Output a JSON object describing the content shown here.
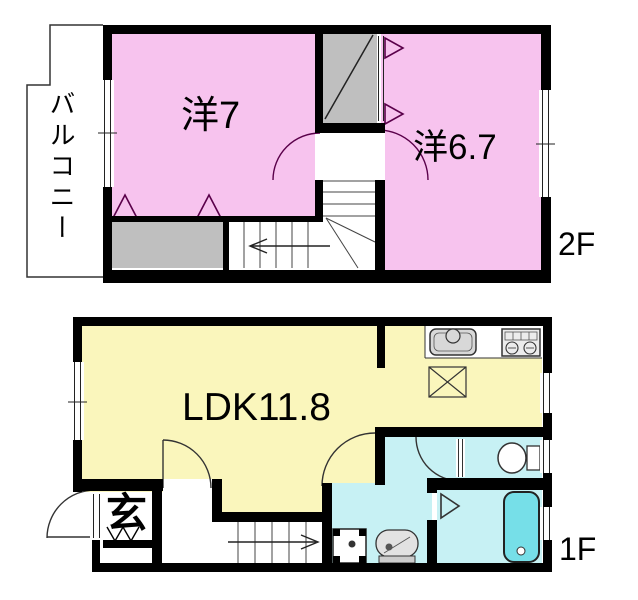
{
  "plan": {
    "floor_2": {
      "floor_label": "2F",
      "balcony_label": "バルコニー",
      "room1_label": "洋7",
      "room2_label": "洋6.7"
    },
    "floor_1": {
      "floor_label": "1F",
      "ldk_label": "LDK11.8",
      "entrance_label": "玄"
    }
  },
  "colors": {
    "room_pink": "#F7C3EE",
    "room_yellow": "#FAF6BC",
    "room_cyan": "#C7F1F4",
    "bathtub_fill": "#76DFE8",
    "closet_gray": "#BFBFBF",
    "fixture_gray": "#D8D8D8",
    "wall_black": "#000000"
  },
  "fixtures": [
    "kitchen-sink",
    "gas-stove",
    "refrigerator-space",
    "staircase-down-2f",
    "staircase-up-1f",
    "toilet",
    "bathtub",
    "washing-machine-pan",
    "wash-basin",
    "entrance-door",
    "closet-2f-room1",
    "closet-2f-room2",
    "balcony",
    "windows"
  ]
}
